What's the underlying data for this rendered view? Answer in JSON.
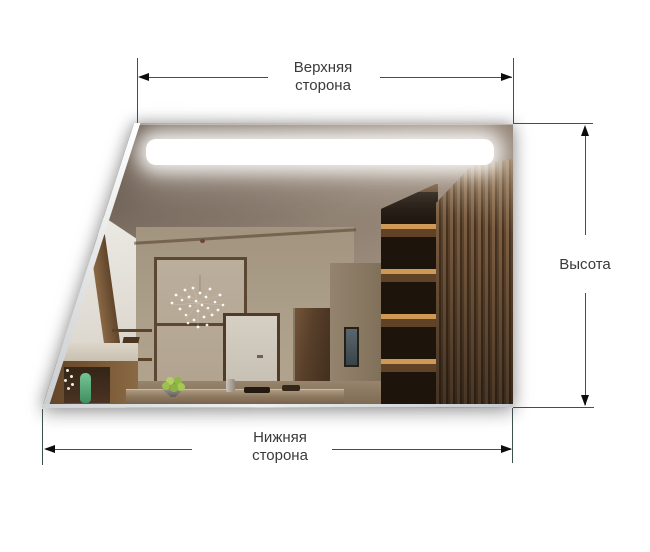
{
  "page": {
    "type": "mirror-dimension-diagram",
    "background": "#ffffff"
  },
  "dimensions": {
    "top_side": {
      "line1": "Верхняя",
      "line2": "сторона"
    },
    "bottom_side": {
      "line1": "Нижняя",
      "line2": "сторона"
    },
    "height": {
      "label": "Высота"
    }
  },
  "style": {
    "dimension_line_color": "#3d524d",
    "arrow_color": "#0d0d0d",
    "label_color": "#3a3a3a",
    "led_strip_color": "#ffffff",
    "wood_slat_dark": "#46321f",
    "wood_slat_light": "#7d5e41",
    "vase_green": "#59b07f"
  },
  "mirror": {
    "shape": "trapezoid",
    "features": "led-strip, interior-room-reflection"
  }
}
